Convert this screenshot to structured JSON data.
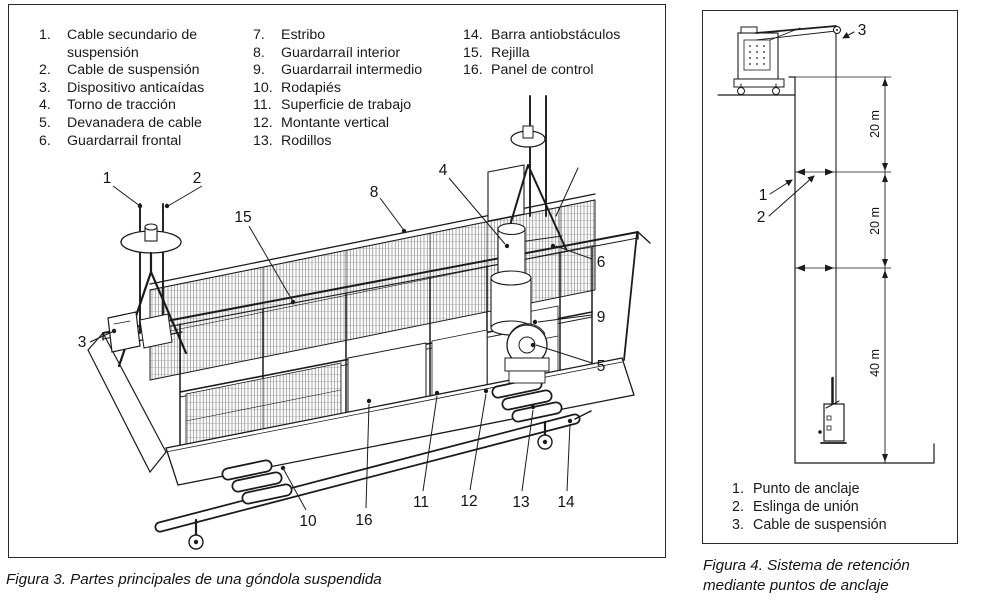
{
  "fig3": {
    "caption": "Figura 3. Partes principales de una góndola suspendida",
    "columns": [
      {
        "items": [
          {
            "num": "1.",
            "label": "Cable secundario de\nsuspensión"
          },
          {
            "num": "2.",
            "label": "Cable de suspensión"
          },
          {
            "num": "3.",
            "label": "Dispositivo anticaídas"
          },
          {
            "num": "4.",
            "label": "Torno de tracción"
          },
          {
            "num": "5.",
            "label": "Devanadera de cable"
          },
          {
            "num": "6.",
            "label": "Guardarrail frontal"
          }
        ]
      },
      {
        "items": [
          {
            "num": "7.",
            "label": "Estribo"
          },
          {
            "num": "8.",
            "label": "Guardarraíl interior"
          },
          {
            "num": "9.",
            "label": "Guardarrail intermedio"
          },
          {
            "num": "10.",
            "label": "Rodapiés"
          },
          {
            "num": "11.",
            "label": "Superficie de trabajo"
          },
          {
            "num": "12.",
            "label": "Montante vertical"
          },
          {
            "num": "13.",
            "label": "Rodillos"
          }
        ]
      },
      {
        "items": [
          {
            "num": "14.",
            "label": "Barra antiobstáculos"
          },
          {
            "num": "15.",
            "label": "Rejilla"
          },
          {
            "num": "16.",
            "label": "Panel de control"
          }
        ]
      }
    ],
    "callouts": [
      "1",
      "2",
      "15",
      "3",
      "8",
      "4",
      "6",
      "9",
      "5",
      "10",
      "16",
      "11",
      "12",
      "13",
      "14"
    ]
  },
  "fig4": {
    "caption_line1": "Figura 4. Sistema de retención",
    "caption_line2": "mediante puntos de anclaje",
    "legend": [
      {
        "num": "1.",
        "label": "Punto de anclaje"
      },
      {
        "num": "2.",
        "label": "Eslinga de unión"
      },
      {
        "num": "3.",
        "label": "Cable de suspensión"
      }
    ],
    "callouts": [
      "3",
      "1",
      "2"
    ],
    "dimensions": [
      "20 m",
      "20 m",
      "40 m"
    ],
    "line_color": "#1b1b1b"
  }
}
